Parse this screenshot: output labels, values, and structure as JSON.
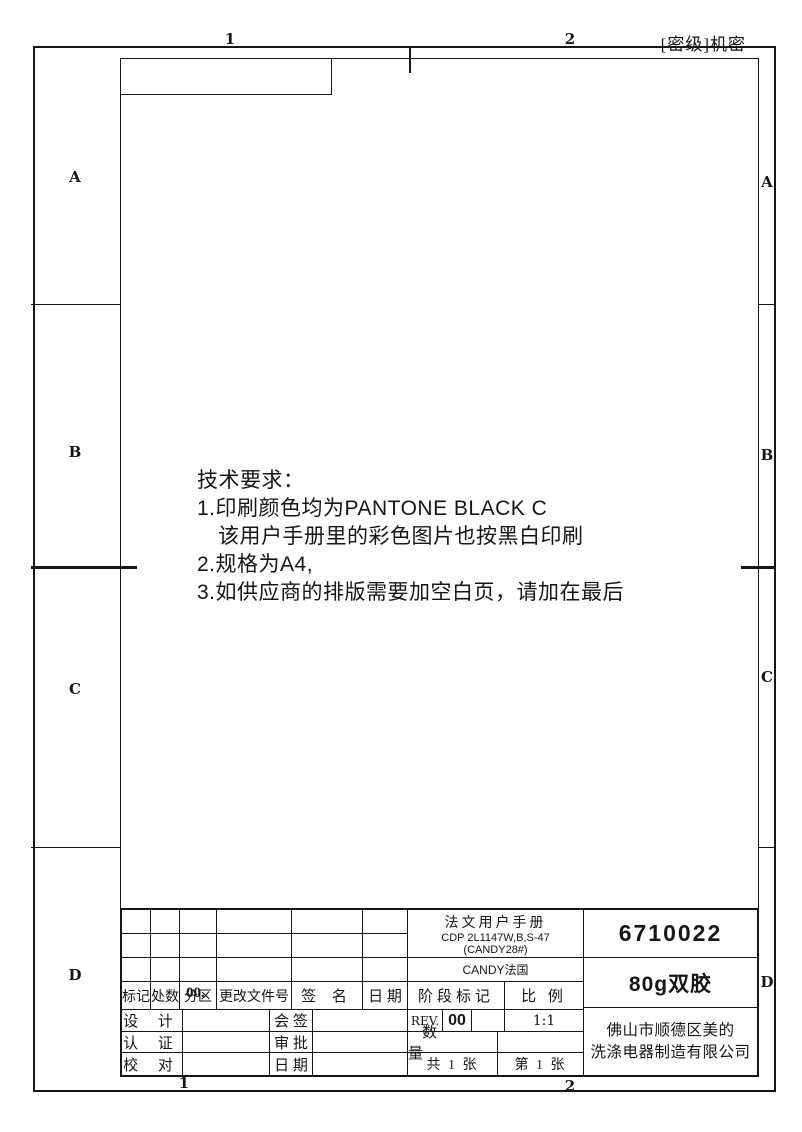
{
  "sheet": {
    "classification": "[密级]机密",
    "rows": [
      "A",
      "B",
      "C",
      "D"
    ],
    "cols": [
      "1",
      "2"
    ]
  },
  "notes": {
    "heading": "技术要求：",
    "lines": [
      "1.印刷颜色均为PANTONE BLACK C",
      "该用户手册里的彩色图片也按黑白印刷",
      "2.规格为A4,",
      "3.如供应商的排版需要加空白页，请加在最后"
    ]
  },
  "title_block": {
    "rev_header": {
      "mark": "标记",
      "count": "处数",
      "zone": "分区",
      "zone_overlay": "00.",
      "doc_no": "更改文件号",
      "sign": "签 名",
      "date": "日 期"
    },
    "approvals": [
      {
        "label": "设 计",
        "value": "",
        "label2": "会 签",
        "value2": ""
      },
      {
        "label": "认 证",
        "value": "",
        "label2": "审 批",
        "value2": ""
      },
      {
        "label": "校 对",
        "value": "",
        "label2": "日 期",
        "value2": ""
      }
    ],
    "product": {
      "name": "法文用户手册",
      "model": "CDP 2L1147W,B,S-47",
      "code": "(CANDY28#)",
      "brand": "CANDY法国"
    },
    "stage": {
      "header": "阶段标记",
      "scale_header": "比 例",
      "rev_label": "REV.",
      "rev_value": "00",
      "scale_value": "1:1"
    },
    "quantity_label": "数 量",
    "sheets": {
      "total": "共 1 张",
      "current": "第 1 张"
    },
    "part_number": "6710022",
    "paper": "80g双胶",
    "company": [
      "佛山市顺德区美的",
      "洗涤电器制造有限公司"
    ]
  }
}
